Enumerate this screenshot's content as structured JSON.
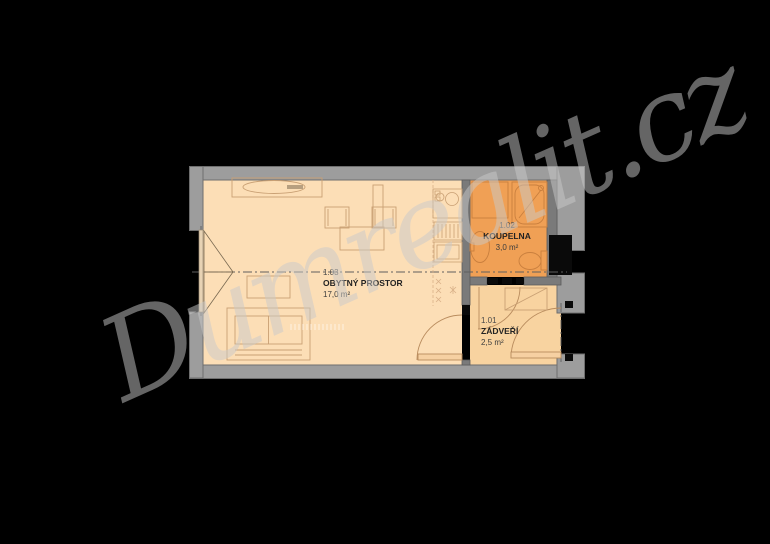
{
  "watermark": {
    "text": "Dumrealit.cz"
  },
  "plan": {
    "rooms": {
      "living": {
        "number": "1.03",
        "name": "OBYTNÝ PROSTOR",
        "area": "17,0 m²"
      },
      "bathroom": {
        "number": "1.02",
        "name": "KOUPELNA",
        "area": "3,0 m²"
      },
      "vestibule": {
        "number": "1.01",
        "name": "ZÁDVEŘÍ",
        "area": "2,5 m²"
      }
    },
    "annotations": {
      "boiler_line1": "bojler 80l",
      "boiler_line2": "/ pračka"
    },
    "colors": {
      "background": "#000000",
      "outer_wall": "#9d9d9d",
      "partition_wall": "#7a7a7a",
      "living_floor": "#fcdeb6",
      "vestibule_floor": "#f8d3a0",
      "bathroom_floor": "#f0a055",
      "furniture_stroke": "#c9a074",
      "watermark_gray": "#cacaca"
    }
  }
}
